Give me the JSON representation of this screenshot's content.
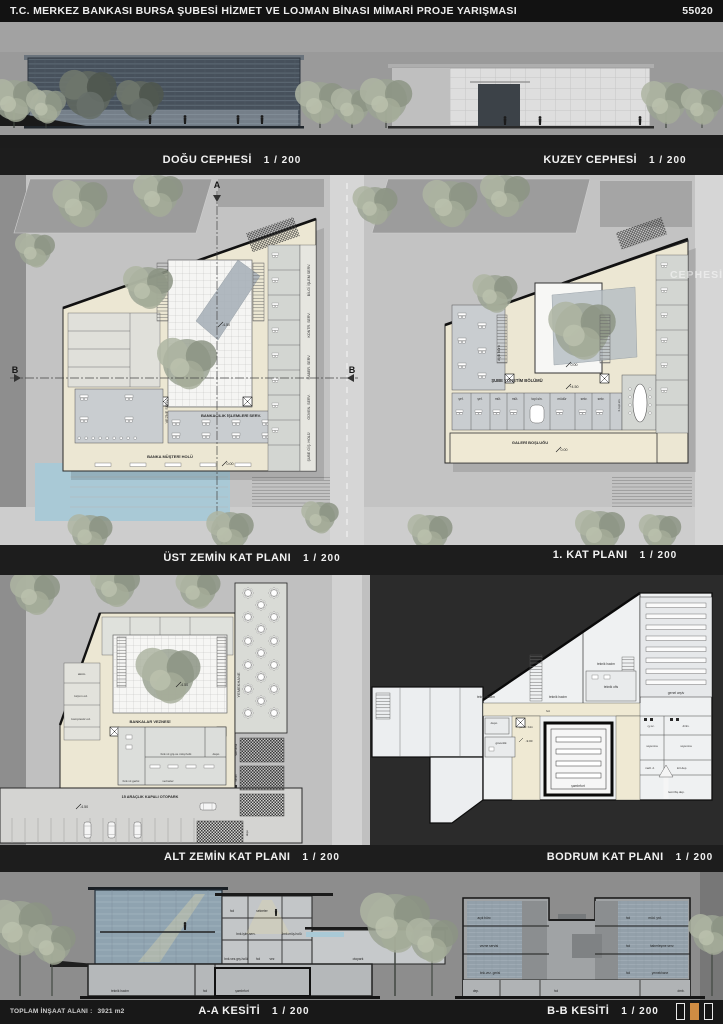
{
  "palette": {
    "board_bg": "#2b2b2b",
    "accent_orange": "#cf8c43",
    "pool_blue": "#a9c9d6",
    "plan_cream": "#ece7d3"
  },
  "header": {
    "title": "T.C. MERKEZ BANKASI BURSA ŞUBESİ HİZMET VE LOJMAN BİNASI MİMARİ PROJE YARIŞMASI",
    "entry_number": "55020"
  },
  "captions": {
    "east": {
      "title": "DOĞU CEPHESİ",
      "scale": "1 / 200"
    },
    "north": {
      "title": "KUZEY CEPHESİ",
      "scale": "1 / 200"
    },
    "upper_ground": {
      "title": "ÜST ZEMİN KAT PLANI",
      "scale": "1 / 200"
    },
    "first_floor": {
      "title": "1. KAT PLANI",
      "scale": "1 / 200"
    },
    "lower_ground": {
      "title": "ALT ZEMİN KAT PLANI",
      "scale": "1 / 200"
    },
    "basement": {
      "title": "BODRUM KAT PLANI",
      "scale": "1 / 200"
    },
    "section_aa": {
      "title": "A-A KESİTİ",
      "scale": "1 / 200"
    },
    "section_bb": {
      "title": "B-B KESİTİ",
      "scale": "1 / 200"
    }
  },
  "markers": {
    "a": "A",
    "b": "B"
  },
  "plan1": {
    "banking_services": "BANKACILIK İŞLEMLERİ SERV.",
    "customer_hall": "BANKA MÜŞTERİ HOLÜ",
    "teller_service": "VEZNE SERV.",
    "it_service": "BİLGİ İŞLEM SERV.",
    "control_service": "KONTR. SERV.",
    "comm_service": "HABER. SERV.",
    "security_service": "GÜVEN. SERV.",
    "branch_hall": "ŞUBE GİŞ. HOLÜ",
    "level_courtyard": "-4.50",
    "level_hall": "0.00"
  },
  "plan2": {
    "management": "ŞUBE YÖNETİM BÖLÜMÜ",
    "gallery_void": "GALERİ BOŞLUĞU",
    "open_office": "açık büro",
    "big_meeting": "b.topl.sln.",
    "rooms": [
      "şef.",
      "şef.",
      "müt.",
      "müt.",
      "topl.sln.",
      "müdür",
      "sekr.",
      "sekr."
    ],
    "level_courtyard": "0.00",
    "level_floor": "+4.50",
    "level_gallery": "0.00",
    "watermark": "CEPHESİ  1 / 200"
  },
  "plan3": {
    "bank_tellers": "BANKALAR VEZNESİ",
    "dining_hall": "YEMEKHANE",
    "parking": "15 ARAÇLIK KAPALI OTOPARK",
    "battery_room": "aköm.",
    "shredding_room": "kırpım od.",
    "compressor_room": "kompresör od.",
    "teller_back": "bnk.vz.gerisi",
    "tellers": "vezneler",
    "teller_entry_hall": "bnk.vz.grş.ve müş.holü",
    "storage_vault": "depo",
    "prep_room": "hazırlama",
    "service_room": "servis",
    "storage_ramp": "depo",
    "level_courtyard": "-4.50",
    "level_parking": "-4.50"
  },
  "plan4": {
    "tech_room_1": "teknik hacim",
    "tech_room_2": "teknik hacim",
    "tech_room_3": "teknik hacim",
    "tech_office": "teknik ofis",
    "general_archive": "genel arşiv",
    "hall": "hol",
    "storage": "depo",
    "security": "güvenlik",
    "vault_hall": "şambr. holü",
    "vault": "şambrfort",
    "tea_station": "çy.oc.",
    "rest_room": "dinln.",
    "locker_1": "soyunma",
    "locker_2": "soyunma",
    "material_storage": "malz. d.",
    "stationery_storage": "kırt.dep.",
    "fixture_storage": "demirbş.dep.",
    "level": "-9.00"
  },
  "section_aa": {
    "hall_top": "hol",
    "secretary": "sekreter",
    "banking_service": "bnk.işlm.serv.",
    "customer_hall": "bnk.müş.holü",
    "teller_entry_hall": "bnk.vez.grş.holü",
    "hall_mid": "hol",
    "teller": "vez",
    "parking": "otopark",
    "tech_room": "teknik hacim",
    "hall_basement": "hol",
    "vault": "şambrfort"
  },
  "section_bb": {
    "open_office": "açık büro",
    "teller_service": "vezne servisi",
    "teller_back": "bnk.vez. gerisi",
    "storage": "dep.",
    "hall_basement": "hol",
    "hall_1": "hol",
    "deputy_manager": "müd. yrd.",
    "hall_2": "hol",
    "comm_service": "haberleşme serv.",
    "hall_3": "hol",
    "dining": "yemekhane",
    "fixtures": "dmb."
  },
  "footer": {
    "total_area_label": "TOPLAM İNŞAAT ALANI :",
    "total_area_value": "3921 m2"
  }
}
